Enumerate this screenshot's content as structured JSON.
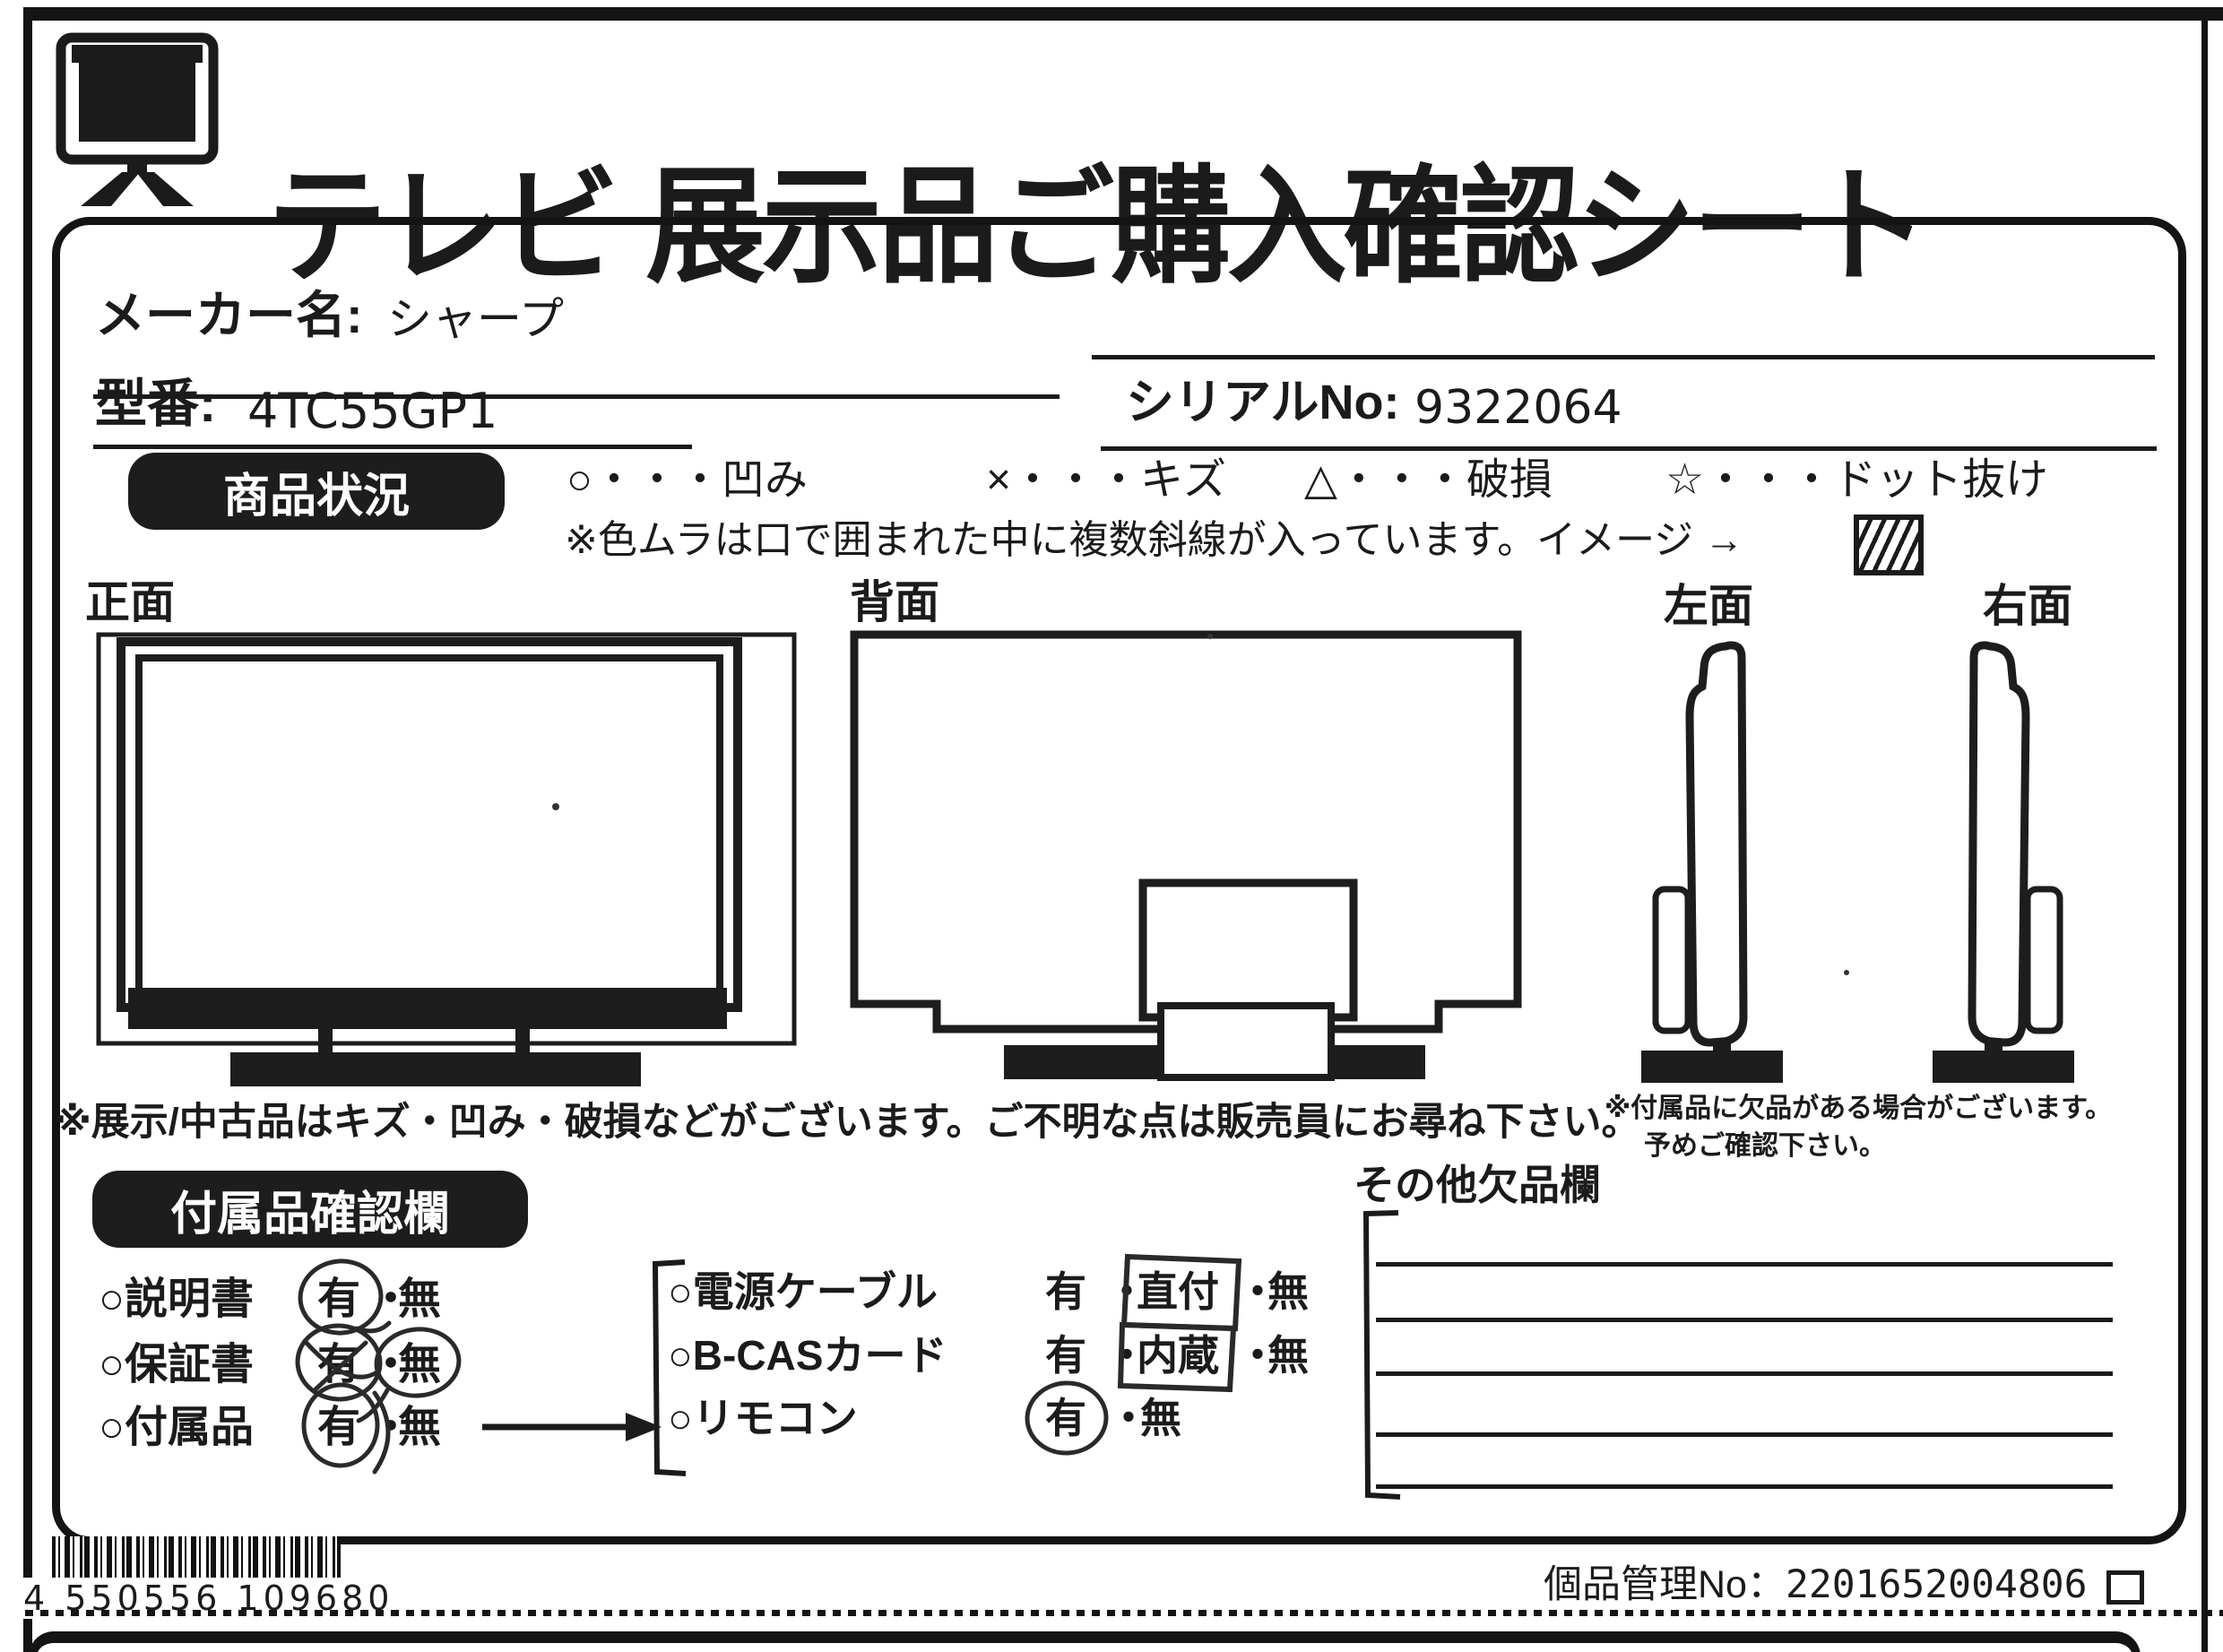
{
  "title": "テレビ 展示品ご購入確認シート",
  "fields": {
    "maker_label": "メーカー名:",
    "maker_value": "シャープ",
    "model_label": "型番:",
    "model_value": "4TC55GP1",
    "serial_label": "シリアルNo:",
    "serial_value": "9322064"
  },
  "condition": {
    "badge": "商品状況",
    "legend": [
      {
        "text": "○・・・凹み"
      },
      {
        "text": "×・・・キズ"
      },
      {
        "text": "△・・・破損"
      },
      {
        "text": "☆・・・ドット抜け"
      }
    ],
    "note": "※色ムラは口で囲まれた中に複数斜線が入っています。イメージ →"
  },
  "views": {
    "front": "正面",
    "back": "背面",
    "left": "左面",
    "right": "右面"
  },
  "notes": {
    "main": "※展示/中古品はキズ・凹み・破損などがございます。ご不明な点は販売員にお尋ね下さい。",
    "sub1": "※付属品に欠品がある場合がございます。",
    "sub2": "予めご確認下さい。"
  },
  "accessories": {
    "badge": "付属品確認欄",
    "yes": "有",
    "no": "無",
    "sep": "・",
    "manual": "○説明書",
    "warranty": "○保証書",
    "included": "○付属品",
    "power": "○電源ケーブル",
    "power_mid": "直付",
    "bcas": "○B-CASカード",
    "bcas_mid": "内蔵",
    "remote": "○リモコン"
  },
  "other_missing": {
    "title": "その他欠品欄"
  },
  "footer": {
    "barcode_digits": "4 550556 109680",
    "manage_label": "個品管理No：",
    "manage_value": "2201652004806"
  }
}
